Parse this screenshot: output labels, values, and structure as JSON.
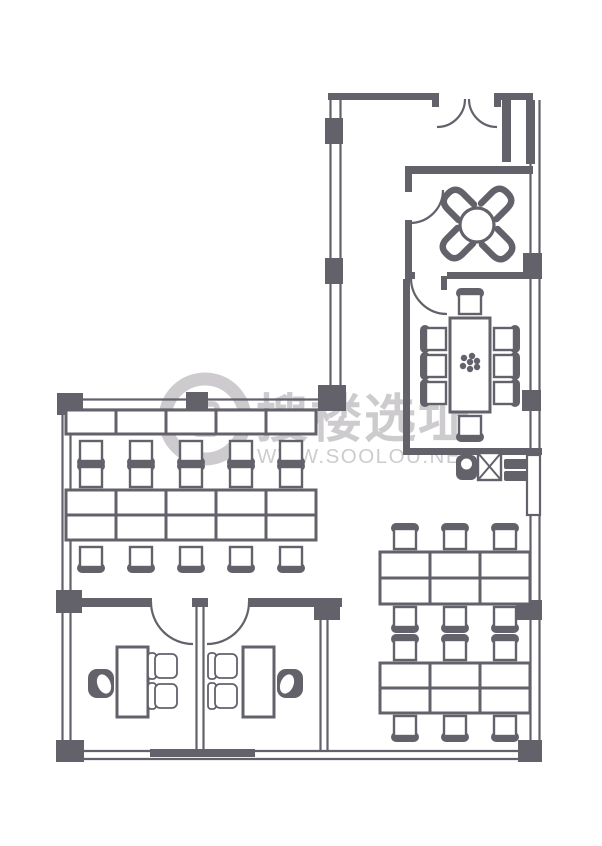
{
  "colors": {
    "wall": "#63616a",
    "floor": "#ffffff",
    "watermark": "#c9c7ca"
  },
  "watermark": {
    "brand": "搜楼选址",
    "url": "WWW.SOOLOU.NET"
  },
  "plan": {
    "shapes": [
      {
        "t": "line",
        "n": "window-west-outer",
        "x1": 62.5,
        "y1": 400,
        "x2": 62.5,
        "y2": 752
      },
      {
        "t": "line",
        "n": "window-west-inner",
        "x1": 70.5,
        "y1": 400,
        "x2": 70.5,
        "y2": 752
      },
      {
        "t": "line",
        "n": "window-north-outer",
        "x1": 62,
        "y1": 399.5,
        "x2": 330,
        "y2": 399.5
      },
      {
        "t": "line",
        "n": "window-north-inner",
        "x1": 62,
        "y1": 409.5,
        "x2": 330,
        "y2": 409.5
      },
      {
        "t": "line",
        "n": "window-south-outer",
        "x1": 62,
        "y1": 751,
        "x2": 530,
        "y2": 751
      },
      {
        "t": "line",
        "n": "window-south-inner",
        "x1": 62,
        "y1": 759,
        "x2": 530,
        "y2": 759
      },
      {
        "t": "line",
        "n": "window-east-outer",
        "x1": 539.5,
        "y1": 100,
        "x2": 539.5,
        "y2": 750
      },
      {
        "t": "line",
        "n": "window-east-inner",
        "x1": 530.5,
        "y1": 100,
        "x2": 530.5,
        "y2": 750
      },
      {
        "t": "line",
        "n": "window-upper-west-outer",
        "x1": 330.5,
        "y1": 97,
        "x2": 330.5,
        "y2": 397
      },
      {
        "t": "line",
        "n": "window-upper-west-inner",
        "x1": 340.5,
        "y1": 97,
        "x2": 340.5,
        "y2": 397
      },
      {
        "t": "line",
        "n": "partition-offices-west",
        "x1": 196.5,
        "y1": 607,
        "x2": 196.5,
        "y2": 751
      },
      {
        "t": "line",
        "n": "partition-offices-east",
        "x1": 203.5,
        "y1": 607,
        "x2": 203.5,
        "y2": 751
      },
      {
        "t": "line",
        "n": "wall-right-office-outer",
        "x1": 320.5,
        "y1": 607,
        "x2": 320.5,
        "y2": 751
      },
      {
        "t": "line",
        "n": "wall-right-office-inner",
        "x1": 327.5,
        "y1": 607,
        "x2": 327.5,
        "y2": 751
      },
      {
        "t": "rect",
        "n": "wall-top-west",
        "x": 328,
        "y": 93,
        "w": 110,
        "h": 7
      },
      {
        "t": "rect",
        "n": "wall-top-east",
        "x": 494,
        "y": 93,
        "w": 39,
        "h": 7
      },
      {
        "t": "rect",
        "n": "entrance-jamb-left",
        "x": 432,
        "y": 93,
        "w": 7,
        "h": 14
      },
      {
        "t": "rect",
        "n": "entrance-jamb-right",
        "x": 494,
        "y": 93,
        "w": 7,
        "h": 14
      },
      {
        "t": "rect",
        "n": "wall-entry-niche",
        "x": 502,
        "y": 100,
        "w": 9,
        "h": 62
      },
      {
        "t": "rect",
        "n": "wall-upper-west-post-1",
        "x": 325,
        "y": 118,
        "w": 18,
        "h": 26
      },
      {
        "t": "rect",
        "n": "wall-upper-west-post-2",
        "x": 325,
        "y": 258,
        "w": 18,
        "h": 26
      },
      {
        "t": "rect",
        "n": "wall-junction-post",
        "x": 318,
        "y": 385,
        "w": 28,
        "h": 26
      },
      {
        "t": "rect",
        "n": "wall-corner-northwest",
        "x": 57,
        "y": 393,
        "w": 26,
        "h": 22
      },
      {
        "t": "rect",
        "n": "wall-north-band-post",
        "x": 186,
        "y": 392,
        "w": 22,
        "h": 21
      },
      {
        "t": "rect",
        "n": "wall-west-mid-post",
        "x": 56,
        "y": 590,
        "w": 26,
        "h": 23
      },
      {
        "t": "rect",
        "n": "wall-corner-southwest",
        "x": 56,
        "y": 740,
        "w": 28,
        "h": 22
      },
      {
        "t": "rect",
        "n": "wall-south-center",
        "x": 150,
        "y": 749,
        "w": 105,
        "h": 8
      },
      {
        "t": "rect",
        "n": "wall-corner-southeast",
        "x": 518,
        "y": 740,
        "w": 24,
        "h": 22
      },
      {
        "t": "rect",
        "n": "wall-east-top-segment",
        "x": 526,
        "y": 100,
        "w": 9,
        "h": 64
      },
      {
        "t": "rect",
        "n": "wall-east-post-1",
        "x": 523,
        "y": 253,
        "w": 19,
        "h": 26
      },
      {
        "t": "rect",
        "n": "wall-east-post-2",
        "x": 522,
        "y": 390,
        "w": 19,
        "h": 21
      },
      {
        "t": "rect",
        "n": "wall-east-post-3",
        "x": 516,
        "y": 600,
        "w": 26,
        "h": 20
      },
      {
        "t": "rect",
        "n": "wall-lounge-north",
        "x": 405,
        "y": 166,
        "w": 128,
        "h": 8
      },
      {
        "t": "rect",
        "n": "wall-lounge-west-stub",
        "x": 405,
        "y": 166,
        "w": 7,
        "h": 26
      },
      {
        "t": "rect",
        "n": "wall-lounge-west-lower",
        "x": 405,
        "y": 220,
        "w": 7,
        "h": 58
      },
      {
        "t": "rect",
        "n": "wall-meeting-north-west",
        "x": 405,
        "y": 272,
        "w": 10,
        "h": 7
      },
      {
        "t": "rect",
        "n": "wall-meeting-north-east",
        "x": 447,
        "y": 272,
        "w": 86,
        "h": 7
      },
      {
        "t": "rect",
        "n": "meeting-door-leaf",
        "x": 441,
        "y": 276,
        "w": 6,
        "h": 14
      },
      {
        "t": "rect",
        "n": "wall-meeting-west",
        "x": 403,
        "y": 279,
        "w": 7,
        "h": 176
      },
      {
        "t": "rect",
        "n": "wall-meeting-south",
        "x": 403,
        "y": 448,
        "w": 139,
        "h": 7
      },
      {
        "t": "rect",
        "n": "wall-offices-north-west",
        "x": 62,
        "y": 598,
        "w": 90,
        "h": 9
      },
      {
        "t": "rect",
        "n": "wall-offices-north-center",
        "x": 192,
        "y": 598,
        "w": 16,
        "h": 9
      },
      {
        "t": "rect",
        "n": "wall-offices-north-east",
        "x": 248,
        "y": 598,
        "w": 94,
        "h": 9
      },
      {
        "t": "rect",
        "n": "wall-offices-east-post",
        "x": 314,
        "y": 598,
        "w": 26,
        "h": 22
      },
      {
        "t": "orect",
        "n": "column-east",
        "x": 527,
        "y": 455,
        "w": 13,
        "h": 60,
        "sw": 2.2
      },
      {
        "t": "arc",
        "n": "entrance-door-arc-left",
        "cx": 437,
        "cy": 99,
        "r": 28,
        "a0": 0,
        "a1": 90
      },
      {
        "t": "arc",
        "n": "entrance-door-arc-right",
        "cx": 497,
        "cy": 99,
        "r": 28,
        "a0": 180,
        "a1": 90
      },
      {
        "t": "arc",
        "n": "lounge-door-arc",
        "cx": 410,
        "cy": 190,
        "r": 33,
        "a0": 0,
        "a1": 90
      },
      {
        "t": "arc",
        "n": "meeting-door-arc",
        "cx": 447,
        "cy": 278,
        "r": 36,
        "a0": 180,
        "a1": 90
      },
      {
        "t": "arc",
        "n": "office-left-door-arc",
        "cx": 193,
        "cy": 602,
        "r": 42,
        "a0": 180,
        "a1": 90
      },
      {
        "t": "arc",
        "n": "office-right-door-arc",
        "cx": 207,
        "cy": 602,
        "r": 42,
        "a0": 0,
        "a1": 90
      },
      {
        "t": "circle",
        "n": "round-table",
        "cx": 477,
        "cy": 225,
        "r": 17,
        "sw": 3.2
      },
      {
        "t": "dchair",
        "n": "lounge-chair",
        "x": 457,
        "y": 203,
        "rot": -45
      },
      {
        "t": "dchair",
        "n": "lounge-chair",
        "x": 498,
        "y": 202,
        "rot": 45
      },
      {
        "t": "dchair",
        "n": "lounge-chair",
        "x": 456,
        "y": 245,
        "rot": -135
      },
      {
        "t": "dchair",
        "n": "lounge-chair",
        "x": 499,
        "y": 246,
        "rot": 135
      },
      {
        "t": "orect",
        "n": "meeting-table",
        "x": 450,
        "y": 318,
        "w": 40,
        "h": 94,
        "sw": 3
      },
      {
        "t": "dots",
        "n": "table-centerpiece",
        "r": 3.2,
        "pts": [
          [
            464,
            358
          ],
          [
            472,
            356
          ],
          [
            477,
            361
          ],
          [
            463,
            366
          ],
          [
            470,
            369
          ],
          [
            477,
            367
          ],
          [
            470,
            362
          ]
        ]
      },
      {
        "t": "chair",
        "n": "meeting-chair",
        "x": 470,
        "y": 304,
        "d": "n"
      },
      {
        "t": "chair",
        "n": "meeting-chair",
        "x": 436,
        "y": 339,
        "d": "w"
      },
      {
        "t": "chair",
        "n": "meeting-chair",
        "x": 436,
        "y": 366,
        "d": "w"
      },
      {
        "t": "chair",
        "n": "meeting-chair",
        "x": 436,
        "y": 393,
        "d": "w"
      },
      {
        "t": "chair",
        "n": "meeting-chair",
        "x": 504,
        "y": 339,
        "d": "e"
      },
      {
        "t": "chair",
        "n": "meeting-chair",
        "x": 504,
        "y": 366,
        "d": "e"
      },
      {
        "t": "chair",
        "n": "meeting-chair",
        "x": 504,
        "y": 393,
        "d": "e"
      },
      {
        "t": "chair",
        "n": "meeting-chair",
        "x": 470,
        "y": 426,
        "d": "s"
      },
      {
        "t": "frect",
        "n": "sink-cabinet",
        "x": 456,
        "y": 455,
        "w": 21,
        "h": 25,
        "rx": 6
      },
      {
        "t": "circle",
        "n": "sink-basin",
        "cx": 466.5,
        "cy": 464,
        "r": 5.5,
        "f": "#ffffff",
        "sw": 0
      },
      {
        "t": "xbox",
        "n": "appliance",
        "x": 478,
        "y": 453,
        "w": 23,
        "h": 27
      },
      {
        "t": "frect",
        "n": "cabinet-upper",
        "x": 504,
        "y": 459,
        "w": 24,
        "h": 10,
        "rx": 2
      },
      {
        "t": "frect",
        "n": "cabinet-lower",
        "x": 504,
        "y": 471,
        "w": 24,
        "h": 10,
        "rx": 2
      },
      {
        "t": "orect",
        "n": "desk",
        "x": 66,
        "y": 410,
        "w": 50,
        "h": 24,
        "sw": 3
      },
      {
        "t": "orect",
        "n": "desk",
        "x": 116,
        "y": 410,
        "w": 50,
        "h": 24,
        "sw": 3
      },
      {
        "t": "orect",
        "n": "desk",
        "x": 166,
        "y": 410,
        "w": 50,
        "h": 24,
        "sw": 3
      },
      {
        "t": "orect",
        "n": "desk",
        "x": 216,
        "y": 410,
        "w": 50,
        "h": 24,
        "sw": 3
      },
      {
        "t": "orect",
        "n": "desk",
        "x": 266,
        "y": 410,
        "w": 50,
        "h": 24,
        "sw": 3
      },
      {
        "t": "chair",
        "n": "office-chair",
        "x": 91,
        "y": 451,
        "d": "s"
      },
      {
        "t": "chair",
        "n": "office-chair",
        "x": 141,
        "y": 451,
        "d": "s"
      },
      {
        "t": "chair",
        "n": "office-chair",
        "x": 191,
        "y": 451,
        "d": "s"
      },
      {
        "t": "chair",
        "n": "office-chair",
        "x": 241,
        "y": 451,
        "d": "s"
      },
      {
        "t": "chair",
        "n": "office-chair",
        "x": 291,
        "y": 451,
        "d": "s"
      },
      {
        "t": "chair",
        "n": "office-chair",
        "x": 91,
        "y": 477,
        "d": "n"
      },
      {
        "t": "chair",
        "n": "office-chair",
        "x": 141,
        "y": 477,
        "d": "n"
      },
      {
        "t": "chair",
        "n": "office-chair",
        "x": 191,
        "y": 477,
        "d": "n"
      },
      {
        "t": "chair",
        "n": "office-chair",
        "x": 241,
        "y": 477,
        "d": "n"
      },
      {
        "t": "chair",
        "n": "office-chair",
        "x": 291,
        "y": 477,
        "d": "n"
      },
      {
        "t": "orect",
        "n": "desk",
        "x": 66,
        "y": 490,
        "w": 50,
        "h": 25,
        "sw": 3
      },
      {
        "t": "orect",
        "n": "desk",
        "x": 116,
        "y": 490,
        "w": 50,
        "h": 25,
        "sw": 3
      },
      {
        "t": "orect",
        "n": "desk",
        "x": 166,
        "y": 490,
        "w": 50,
        "h": 25,
        "sw": 3
      },
      {
        "t": "orect",
        "n": "desk",
        "x": 216,
        "y": 490,
        "w": 50,
        "h": 25,
        "sw": 3
      },
      {
        "t": "orect",
        "n": "desk",
        "x": 266,
        "y": 490,
        "w": 50,
        "h": 25,
        "sw": 3
      },
      {
        "t": "orect",
        "n": "desk",
        "x": 66,
        "y": 515,
        "w": 50,
        "h": 25,
        "sw": 3
      },
      {
        "t": "orect",
        "n": "desk",
        "x": 116,
        "y": 515,
        "w": 50,
        "h": 25,
        "sw": 3
      },
      {
        "t": "orect",
        "n": "desk",
        "x": 166,
        "y": 515,
        "w": 50,
        "h": 25,
        "sw": 3
      },
      {
        "t": "orect",
        "n": "desk",
        "x": 216,
        "y": 515,
        "w": 50,
        "h": 25,
        "sw": 3
      },
      {
        "t": "orect",
        "n": "desk",
        "x": 266,
        "y": 515,
        "w": 50,
        "h": 25,
        "sw": 3
      },
      {
        "t": "chair",
        "n": "office-chair",
        "x": 91,
        "y": 557,
        "d": "s"
      },
      {
        "t": "chair",
        "n": "office-chair",
        "x": 141,
        "y": 557,
        "d": "s"
      },
      {
        "t": "chair",
        "n": "office-chair",
        "x": 191,
        "y": 557,
        "d": "s"
      },
      {
        "t": "chair",
        "n": "office-chair",
        "x": 241,
        "y": 557,
        "d": "s"
      },
      {
        "t": "chair",
        "n": "office-chair",
        "x": 291,
        "y": 557,
        "d": "s"
      },
      {
        "t": "chair",
        "n": "office-chair",
        "x": 405,
        "y": 539,
        "d": "n"
      },
      {
        "t": "chair",
        "n": "office-chair",
        "x": 455,
        "y": 539,
        "d": "n"
      },
      {
        "t": "chair",
        "n": "office-chair",
        "x": 505,
        "y": 539,
        "d": "n"
      },
      {
        "t": "orect",
        "n": "desk",
        "x": 380,
        "y": 552,
        "w": 50,
        "h": 26,
        "sw": 3
      },
      {
        "t": "orect",
        "n": "desk",
        "x": 430,
        "y": 552,
        "w": 50,
        "h": 26,
        "sw": 3
      },
      {
        "t": "orect",
        "n": "desk",
        "x": 480,
        "y": 552,
        "w": 50,
        "h": 26,
        "sw": 3
      },
      {
        "t": "orect",
        "n": "desk",
        "x": 380,
        "y": 578,
        "w": 50,
        "h": 26,
        "sw": 3
      },
      {
        "t": "orect",
        "n": "desk",
        "x": 430,
        "y": 578,
        "w": 50,
        "h": 26,
        "sw": 3
      },
      {
        "t": "orect",
        "n": "desk",
        "x": 480,
        "y": 578,
        "w": 50,
        "h": 26,
        "sw": 3
      },
      {
        "t": "chair",
        "n": "office-chair",
        "x": 405,
        "y": 617,
        "d": "s"
      },
      {
        "t": "chair",
        "n": "office-chair",
        "x": 455,
        "y": 617,
        "d": "s"
      },
      {
        "t": "chair",
        "n": "office-chair",
        "x": 505,
        "y": 617,
        "d": "s"
      },
      {
        "t": "chair",
        "n": "office-chair",
        "x": 405,
        "y": 650,
        "d": "n"
      },
      {
        "t": "chair",
        "n": "office-chair",
        "x": 455,
        "y": 650,
        "d": "n"
      },
      {
        "t": "chair",
        "n": "office-chair",
        "x": 505,
        "y": 650,
        "d": "n"
      },
      {
        "t": "orect",
        "n": "desk",
        "x": 380,
        "y": 663,
        "w": 50,
        "h": 25,
        "sw": 3
      },
      {
        "t": "orect",
        "n": "desk",
        "x": 430,
        "y": 663,
        "w": 50,
        "h": 25,
        "sw": 3
      },
      {
        "t": "orect",
        "n": "desk",
        "x": 480,
        "y": 663,
        "w": 50,
        "h": 25,
        "sw": 3
      },
      {
        "t": "orect",
        "n": "desk",
        "x": 380,
        "y": 688,
        "w": 50,
        "h": 25,
        "sw": 3
      },
      {
        "t": "orect",
        "n": "desk",
        "x": 430,
        "y": 688,
        "w": 50,
        "h": 25,
        "sw": 3
      },
      {
        "t": "orect",
        "n": "desk",
        "x": 480,
        "y": 688,
        "w": 50,
        "h": 25,
        "sw": 3
      },
      {
        "t": "chair",
        "n": "office-chair",
        "x": 405,
        "y": 726,
        "d": "s"
      },
      {
        "t": "chair",
        "n": "office-chair",
        "x": 455,
        "y": 726,
        "d": "s"
      },
      {
        "t": "chair",
        "n": "office-chair",
        "x": 505,
        "y": 726,
        "d": "s"
      },
      {
        "t": "orect",
        "n": "office-desk",
        "x": 117,
        "y": 647,
        "w": 31,
        "h": 70,
        "sw": 3
      },
      {
        "t": "orect",
        "n": "office-desk",
        "x": 243,
        "y": 647,
        "w": 31,
        "h": 70,
        "sw": 3
      },
      {
        "t": "xchair",
        "n": "executive-chair",
        "x": 88,
        "y": 669,
        "flip": "e"
      },
      {
        "t": "xchair",
        "n": "executive-chair",
        "x": 277,
        "y": 669,
        "flip": "w"
      },
      {
        "t": "gchair",
        "n": "guest-chair",
        "x": 155,
        "y": 654
      },
      {
        "t": "gchair",
        "n": "guest-chair",
        "x": 155,
        "y": 684
      },
      {
        "t": "gchair",
        "n": "guest-chair",
        "x": 215,
        "y": 654
      },
      {
        "t": "gchair",
        "n": "guest-chair",
        "x": 215,
        "y": 684
      }
    ]
  }
}
